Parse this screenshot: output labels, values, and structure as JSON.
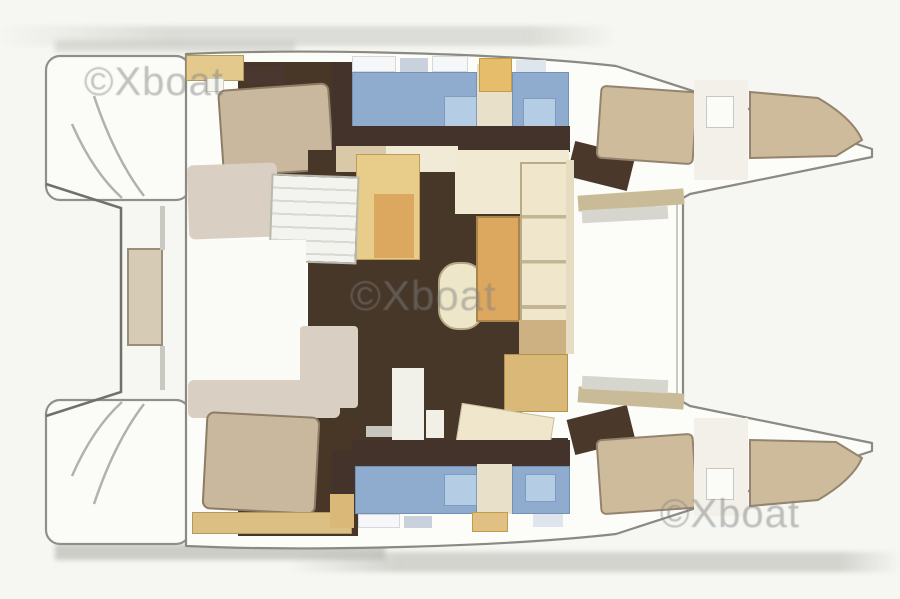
{
  "figure": {
    "kind": "catamaran-yacht-floor-plan",
    "orientation": "horizontal, hull bows pointed to the right, twin stern platforms at left"
  },
  "watermarks": [
    {
      "text": "©Xboat"
    },
    {
      "text": "©Xboat"
    },
    {
      "text": "©Xboat"
    }
  ],
  "palette": {
    "background": "#f6f6f2",
    "hull_fill": "#fcfcf9",
    "outline_gray": "#8a8a82",
    "light_line": "#b2b2aa",
    "floor_dark_wood": "#473629",
    "bed_beige": "#c9b89d",
    "bed_tan": "#cdbb9c",
    "cabinet_yellow": "#e8cc8a",
    "cabinet_orange": "#dca75f",
    "counter_cream": "#efe6cb",
    "seat_light": "#d9d0c3",
    "bathroom_blue": "#8fabcd",
    "shower_blue": "#b5cde4",
    "deck_tan": "#c9bb97",
    "watermark_gray": "rgba(128,128,128,0.48)"
  }
}
